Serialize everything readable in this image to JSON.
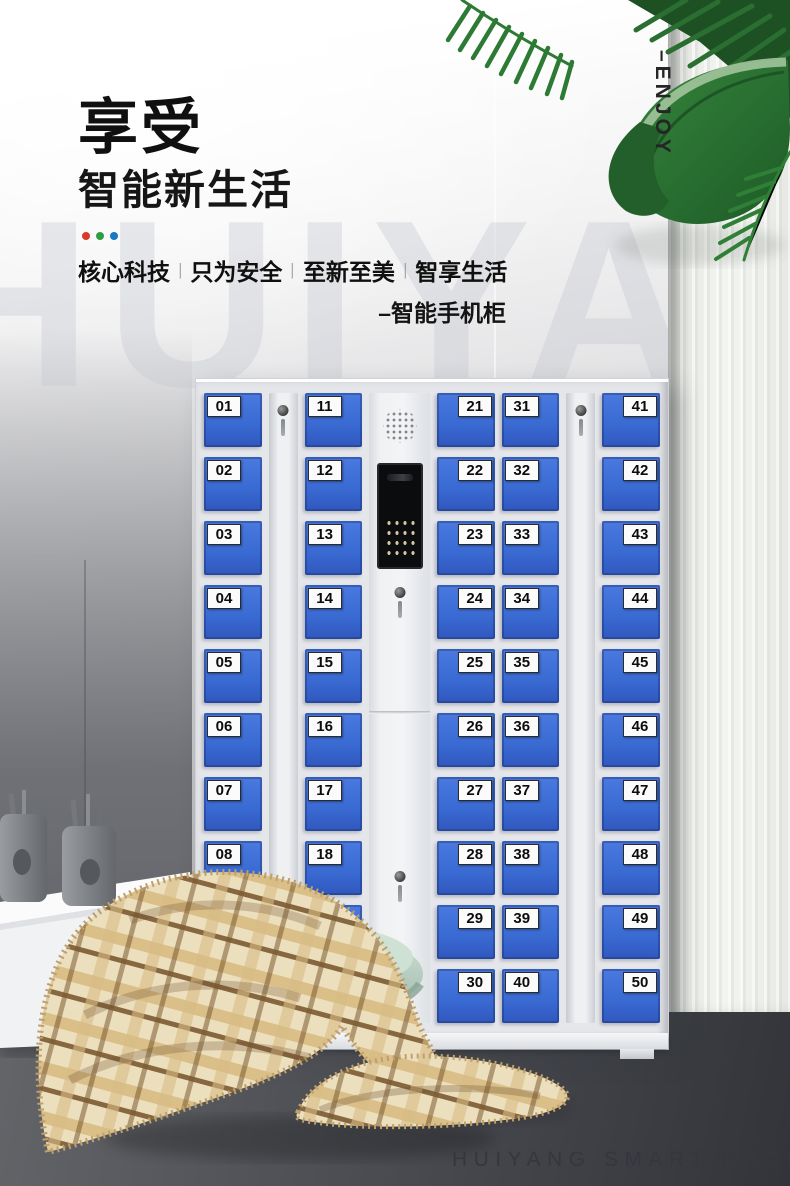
{
  "hero": {
    "title": "享受",
    "subtitle": "智能新生活",
    "dots": [
      "#d93a2b",
      "#2e9e44",
      "#1779c4"
    ],
    "tagline": [
      "核心科技",
      "只为安全",
      "至新至美",
      "智享生活"
    ],
    "divider": "|",
    "sub_label": "–智能手机柜",
    "vertical_label": "–ENJOY",
    "watermark": "HUIYANG"
  },
  "cabinet": {
    "door_color": "#3a6bd4",
    "frame_color": "#e4e6ea",
    "columns": [
      {
        "type": "doors",
        "tag_side": "left",
        "numbers": [
          "01",
          "02",
          "03",
          "04",
          "05",
          "06",
          "07",
          "08",
          "09",
          "10"
        ]
      },
      {
        "type": "lock"
      },
      {
        "type": "doors",
        "tag_side": "left",
        "numbers": [
          "11",
          "12",
          "13",
          "14",
          "15",
          "16",
          "17",
          "18",
          "19",
          "20"
        ]
      },
      {
        "type": "panel"
      },
      {
        "type": "doors",
        "tag_side": "right",
        "numbers": [
          "21",
          "22",
          "23",
          "24",
          "25",
          "26",
          "27",
          "28",
          "29",
          "30"
        ]
      },
      {
        "type": "doors",
        "tag_side": "left",
        "numbers": [
          "31",
          "32",
          "33",
          "34",
          "35",
          "36",
          "37",
          "38",
          "39",
          "40"
        ]
      },
      {
        "type": "lock"
      },
      {
        "type": "doors",
        "tag_side": "right",
        "numbers": [
          "41",
          "42",
          "43",
          "44",
          "45",
          "46",
          "47",
          "48",
          "49",
          "50"
        ]
      }
    ]
  },
  "footer": {
    "caption": "HUIYANG SMART PHONE CABINET"
  }
}
